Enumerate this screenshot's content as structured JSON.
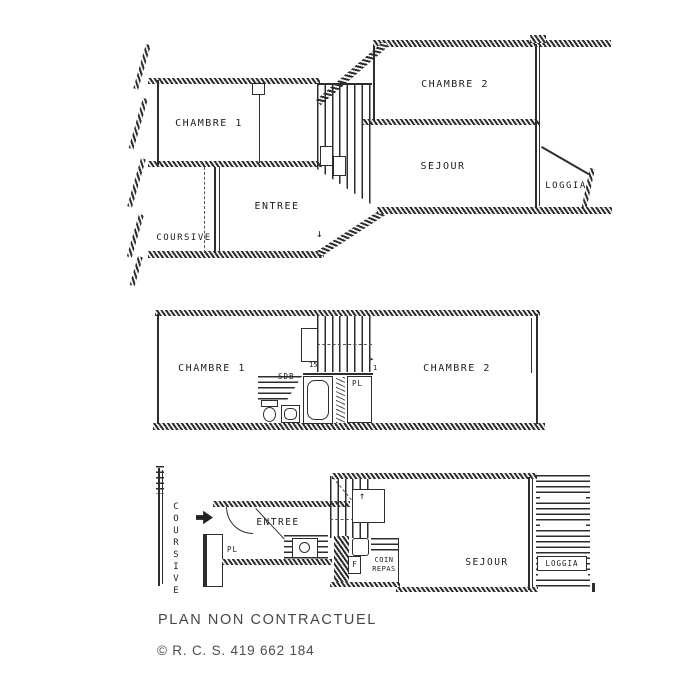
{
  "page": {
    "background": "#ffffff"
  },
  "colors": {
    "ink": "#2d2d2d",
    "footer_text": "#44474e"
  },
  "footer": {
    "disclaimer": "PLAN NON CONTRACTUEL",
    "copyright": "© R. C. S. 419 662 184"
  },
  "plans": {
    "upper": {
      "chambre1": "CHAMBRE 1",
      "chambre2": "CHAMBRE 2",
      "sejour": "SEJOUR",
      "loggia": "LOGGIA",
      "entree": "ENTREE",
      "coursive": "COURSIVE",
      "stair_down_arrow": "↓"
    },
    "middle": {
      "chambre1": "CHAMBRE 1",
      "chambre2": "CHAMBRE 2",
      "sdb": "SDB",
      "pl": "PL",
      "stair_steps": "15",
      "stair_run": "1",
      "stair_arrow": "▸"
    },
    "lower": {
      "coursive": "COURSIVE",
      "entree": "ENTREE",
      "pl": "PL",
      "fridge": "F",
      "coin_repas": "COIN REPAS",
      "sejour": "SEJOUR",
      "loggia": "LOGGIA",
      "stair_up_arrow": "↑"
    }
  }
}
